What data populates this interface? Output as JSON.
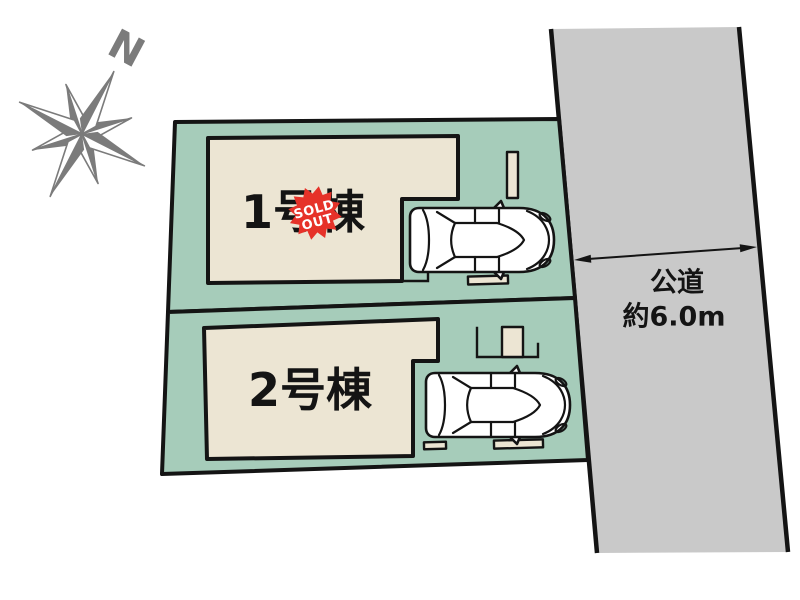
{
  "compass": {
    "north_label": "N"
  },
  "lots": {
    "lot1": {
      "label": "1号棟",
      "badge": {
        "line1": "SOLD",
        "line2": "OUT"
      }
    },
    "lot2": {
      "label": "2号棟"
    }
  },
  "road": {
    "label": "公道",
    "width_label": "約6.0m"
  },
  "colors": {
    "parcel_green": "#a6ccba",
    "building_beige": "#ece5d3",
    "road_gray": "#c9c9c9",
    "badge_red": "#e63229",
    "compass_gray": "#7b7b7b",
    "outline_black": "#141414"
  }
}
